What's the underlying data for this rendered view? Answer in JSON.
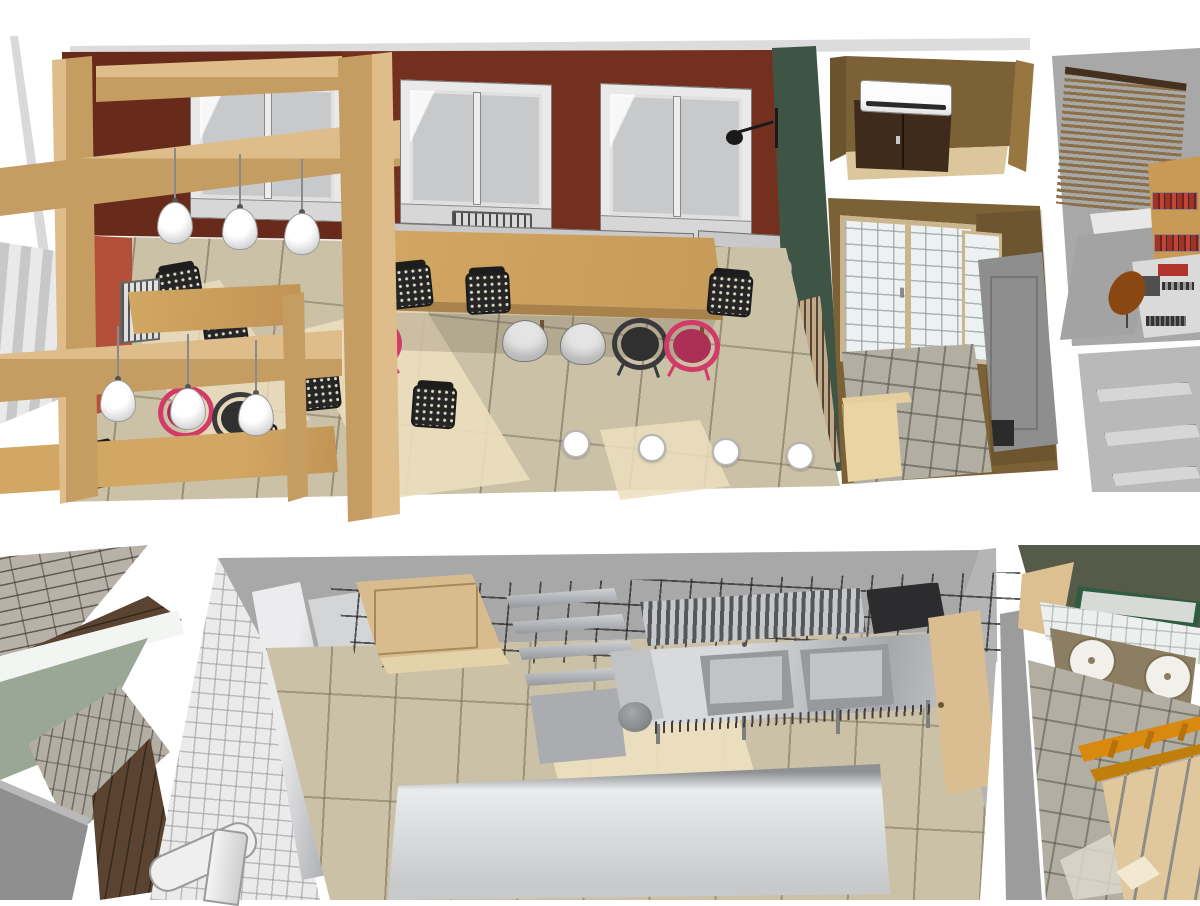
{
  "meta": {
    "title": "cafe-interior-3d-cutaway-renders",
    "views": [
      {
        "id": "upper",
        "name": "dining-area-axonometric-cutaway"
      },
      {
        "id": "lower",
        "name": "kitchen-axonometric-cutaway"
      }
    ]
  },
  "palette": {
    "wall_red": "#74301f",
    "wall_orange": "#b4503a",
    "wall_green": "#3e5546",
    "wall_brown": "#7d6136",
    "door_dark": "#3f2b1c",
    "wood_light": "#dfbd8a",
    "wood_mid": "#c59c62",
    "wood_table": "#d2a763",
    "floor_tile": "#cbc1a6",
    "floor_light": "#ecdfc0",
    "tile_gray": "#b3aea2",
    "gray_wall": "#a8a8a8",
    "glass": "#c7c9cb",
    "sage": "#9aa795",
    "olive": "#565a48",
    "wood_floor": "#5a4330",
    "pink": "#d23a68",
    "orange": "#d8890f",
    "book_red": "#a03226",
    "steel_light": "#e8e8ea",
    "steel_dark": "#8e9093",
    "green_frame": "#2f5c40"
  },
  "upper_view": {
    "rooms": [
      "dining-room",
      "entry-hall",
      "bathroom",
      "office",
      "storage-room"
    ],
    "dining": {
      "windows": 3,
      "radiators": 2,
      "wall_benches": 2,
      "pendant_lamps": 6,
      "sphere_wall_lamps": 3,
      "black_wall_lamps": 2,
      "floor_spotlights": 4,
      "long_table": 1,
      "wood_tables": 2,
      "chairs_black_mesh": 9,
      "chairs_white_shell": 2,
      "chairs_round_dark": 2,
      "chairs_round_pink": 4,
      "timber_posts": 3,
      "timber_beams": 3
    },
    "entry_hall": {
      "ac_unit": 1,
      "dark_double_door": 1
    },
    "bathroom": {
      "glazed_door": 1,
      "gray_door": 1,
      "tiled_floor": true
    },
    "office": {
      "slat_blind": 1,
      "book_shelves": 2,
      "machines_desk": 1,
      "chair_brown": 1,
      "rug": 1
    },
    "storage_room": {
      "shelves": 3
    }
  },
  "lower_view": {
    "rooms": [
      "bar-front",
      "kitchen",
      "washroom"
    ],
    "bar_front": {
      "brick_walls": 2,
      "dark_wood_floors": 2,
      "sage_walls": 1,
      "gray_counter": 1
    },
    "kitchen": {
      "steel_cabinets": 3,
      "white_pipe": 1,
      "wire_canopy": 1,
      "wood_doors": 2,
      "tier_shelves": 4,
      "slat_rack": 1,
      "vent_grill": 1,
      "sink_basins": 2,
      "prep_table": 1,
      "round_bin": 1,
      "foreground_counters": 2,
      "light_patches": 2
    },
    "washroom": {
      "vanity_basins": 2,
      "green_framed_glass": 1,
      "ladder_beams": 2,
      "plank_floor": true
    }
  }
}
